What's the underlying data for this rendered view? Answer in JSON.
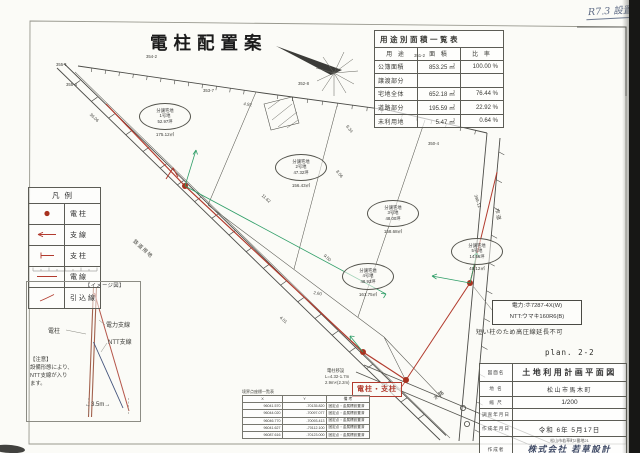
{
  "page": {
    "handwritten_note": "R7.3 設置",
    "title": "電柱配置案",
    "plan_number": "plan. 2-2"
  },
  "area_table": {
    "title": "用途別面積一覧表",
    "col_use": "用 途",
    "col_area": "面 積",
    "col_ratio": "比 率",
    "rows": [
      {
        "use": "公簿面積",
        "area": "853.25 ㎡",
        "ratio": "100.00 %"
      },
      {
        "use": "譲渡部分",
        "area": "",
        "ratio": ""
      },
      {
        "use": "宅地全体",
        "area": "652.18 ㎡",
        "ratio": "76.44 %"
      },
      {
        "use": "道路部分",
        "area": "195.59 ㎡",
        "ratio": "22.92 %"
      },
      {
        "use": "未利用地",
        "area": "5.47 ㎡",
        "ratio": "0.64 %"
      }
    ]
  },
  "legend": {
    "title": "凡例",
    "items": [
      {
        "label": "電柱"
      },
      {
        "label": "支線"
      },
      {
        "label": "支柱"
      },
      {
        "label": "電線"
      },
      {
        "label": "引込線"
      }
    ]
  },
  "image_diagram": {
    "title": "【イメージ図】",
    "pole_label": "電柱",
    "power_label": "電力支線",
    "ntt_label": "NTT支線",
    "note_line1": "【注意】",
    "note_line2": "設備形態により、",
    "note_line3": "NTT支線が入り",
    "note_line4": "ます。",
    "dimension": "←3.5m→"
  },
  "callouts": {
    "pole_box": "電柱・支柱",
    "utility_line1": "電力:ホ7287-4X(W)",
    "utility_line2": "NTT:ウマキ160R6(B)",
    "high_voltage_note": "短い柱のため高圧線延長不可"
  },
  "plots": [
    {
      "line1": "分譲宅地",
      "line2": "1号地",
      "line3": "52.97坪",
      "area": "175.12㎡"
    },
    {
      "line1": "分譲宅地",
      "line2": "2号地",
      "line3": "47.32坪",
      "area": "156.43㎡"
    },
    {
      "line1": "分譲宅地",
      "line2": "3号地",
      "line3": "48.00坪",
      "area": "158.68㎡"
    },
    {
      "line1": "分譲宅地",
      "line2": "4号地",
      "line3": "48.93坪",
      "area": "161.75㎡"
    },
    {
      "line1": "分譲宅地",
      "line2": "5号地",
      "line3": "14.56坪",
      "area": "48.12㎡"
    }
  ],
  "coord_table": {
    "title": "境界点座標一覧表",
    "col_x": "X",
    "col_y": "Y",
    "col_note": "備 考",
    "rows": [
      {
        "x": "96041.570",
        "y": "-70135.820",
        "note": "固定点・金属標設置済"
      },
      {
        "x": "96044.020",
        "y": "-70097.077",
        "note": "固定点・金属標設置済"
      },
      {
        "x": "96046.770",
        "y": "-70093.413",
        "note": "固定点・金属標設置済"
      },
      {
        "x": "96041.627",
        "y": "-70112.100",
        "note": "固定点・金属標設置済"
      },
      {
        "x": "96087.616",
        "y": "-70123.000",
        "note": "固定点・金属標設置済"
      }
    ]
  },
  "title_block": {
    "row1_label": "図面名",
    "row1_value": "土地利用計画平面図",
    "row2_label": "地 名",
    "row2_value": "松山市馬木町",
    "row3_label": "縮 尺",
    "row3_value": "1/200",
    "row4_label": "調査年月日",
    "row4_value": "",
    "row5_label": "作成年月日",
    "row5_value": "令和 6年 5月17日",
    "row6_label": "作成者",
    "row6_line1": "松山市若草町2番地21",
    "row6_line2": "株式会社 若草設計",
    "row6_line3": "代表取締役 石丸勝利"
  },
  "annotations": [
    {
      "text": "355-1"
    },
    {
      "text": "355-4"
    },
    {
      "text": "354-2"
    },
    {
      "text": "353-7"
    },
    {
      "text": "352-8"
    },
    {
      "text": "351-2"
    },
    {
      "text": "350-4"
    },
    {
      "text": "398-12"
    },
    {
      "text": "市道"
    },
    {
      "text": "鉄道用地"
    },
    {
      "text": "36.06"
    },
    {
      "text": "4.92"
    },
    {
      "text": "6.34"
    },
    {
      "text": "11.62"
    },
    {
      "text": "8.56"
    },
    {
      "text": "9.50"
    },
    {
      "text": "2.60"
    },
    {
      "text": "4.01"
    },
    {
      "text": "水路"
    },
    {
      "text": "電柱移設"
    },
    {
      "text": "L=4.32-1.7m"
    },
    {
      "text": "2.9m×(2.2m)"
    }
  ]
}
